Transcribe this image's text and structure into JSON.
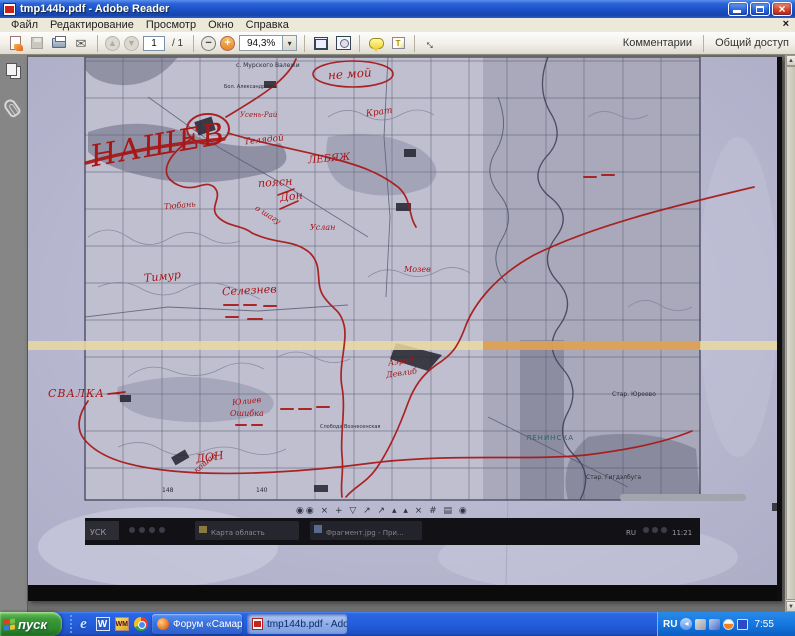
{
  "window": {
    "title": "tmp144b.pdf - Adobe Reader"
  },
  "menubar": {
    "items": [
      "Файл",
      "Редактирование",
      "Просмотр",
      "Окно",
      "Справка"
    ],
    "close_x": "×"
  },
  "toolbar": {
    "page_value": "1",
    "of_label": "/ 1",
    "zoom_value": "94,3%",
    "zoom_drop": "▾",
    "prev_glyph": "▲",
    "next_glyph": "▼",
    "minus_glyph": "−",
    "plus_glyph": "+",
    "fullscreen_glyph": "↔",
    "mail_glyph": "✉",
    "note_glyph": "T",
    "comments_label": "Комментарии",
    "share_label": "Общий доступ"
  },
  "scrollbar": {
    "up": "▲",
    "down": "▼"
  },
  "map": {
    "red": [
      "НАШЕВ",
      "не мой",
      "Усень-Рай",
      "Телядой",
      "Крат",
      "ЛЕБЯЖ",
      "поясн",
      "Дон",
      "о шагу",
      "Тюбань",
      "Услан",
      "Тимур",
      "Селезнев",
      "Мозев",
      "Аэрод",
      "Девлиб",
      "кошав",
      "Юлиев",
      "Ошибка",
      "СВАЛКА —",
      "ДОН"
    ],
    "black": [
      "с. Мурского Валежи",
      "Бол. Александровка",
      "Слобода Вознесенская",
      "Стар. Юреево",
      "Стар. Гигдэлбуга",
      "148",
      "140"
    ],
    "teal": [
      "ЛЕНИНСКА"
    ],
    "shot": {
      "glyphs": "◉◉  × + ▽  ↗ ↗  ▴ ▴  ×  # ▤ ◉",
      "start": "УСК",
      "btn1": "Карта область",
      "btn2": "Фрагмент.jpg - При...",
      "lang": "RU",
      "time": "11:21"
    }
  },
  "taskbar": {
    "start_label": "пуск",
    "chevron": "»",
    "ie_glyph": "e",
    "word_glyph": "W",
    "wm_glyph": "WM",
    "buttons": [
      "Форум «Самарского ...",
      "tmp144b.pdf - Adobe..."
    ],
    "tray": {
      "lang": "RU",
      "chev": "◂",
      "time": "7:55"
    }
  }
}
